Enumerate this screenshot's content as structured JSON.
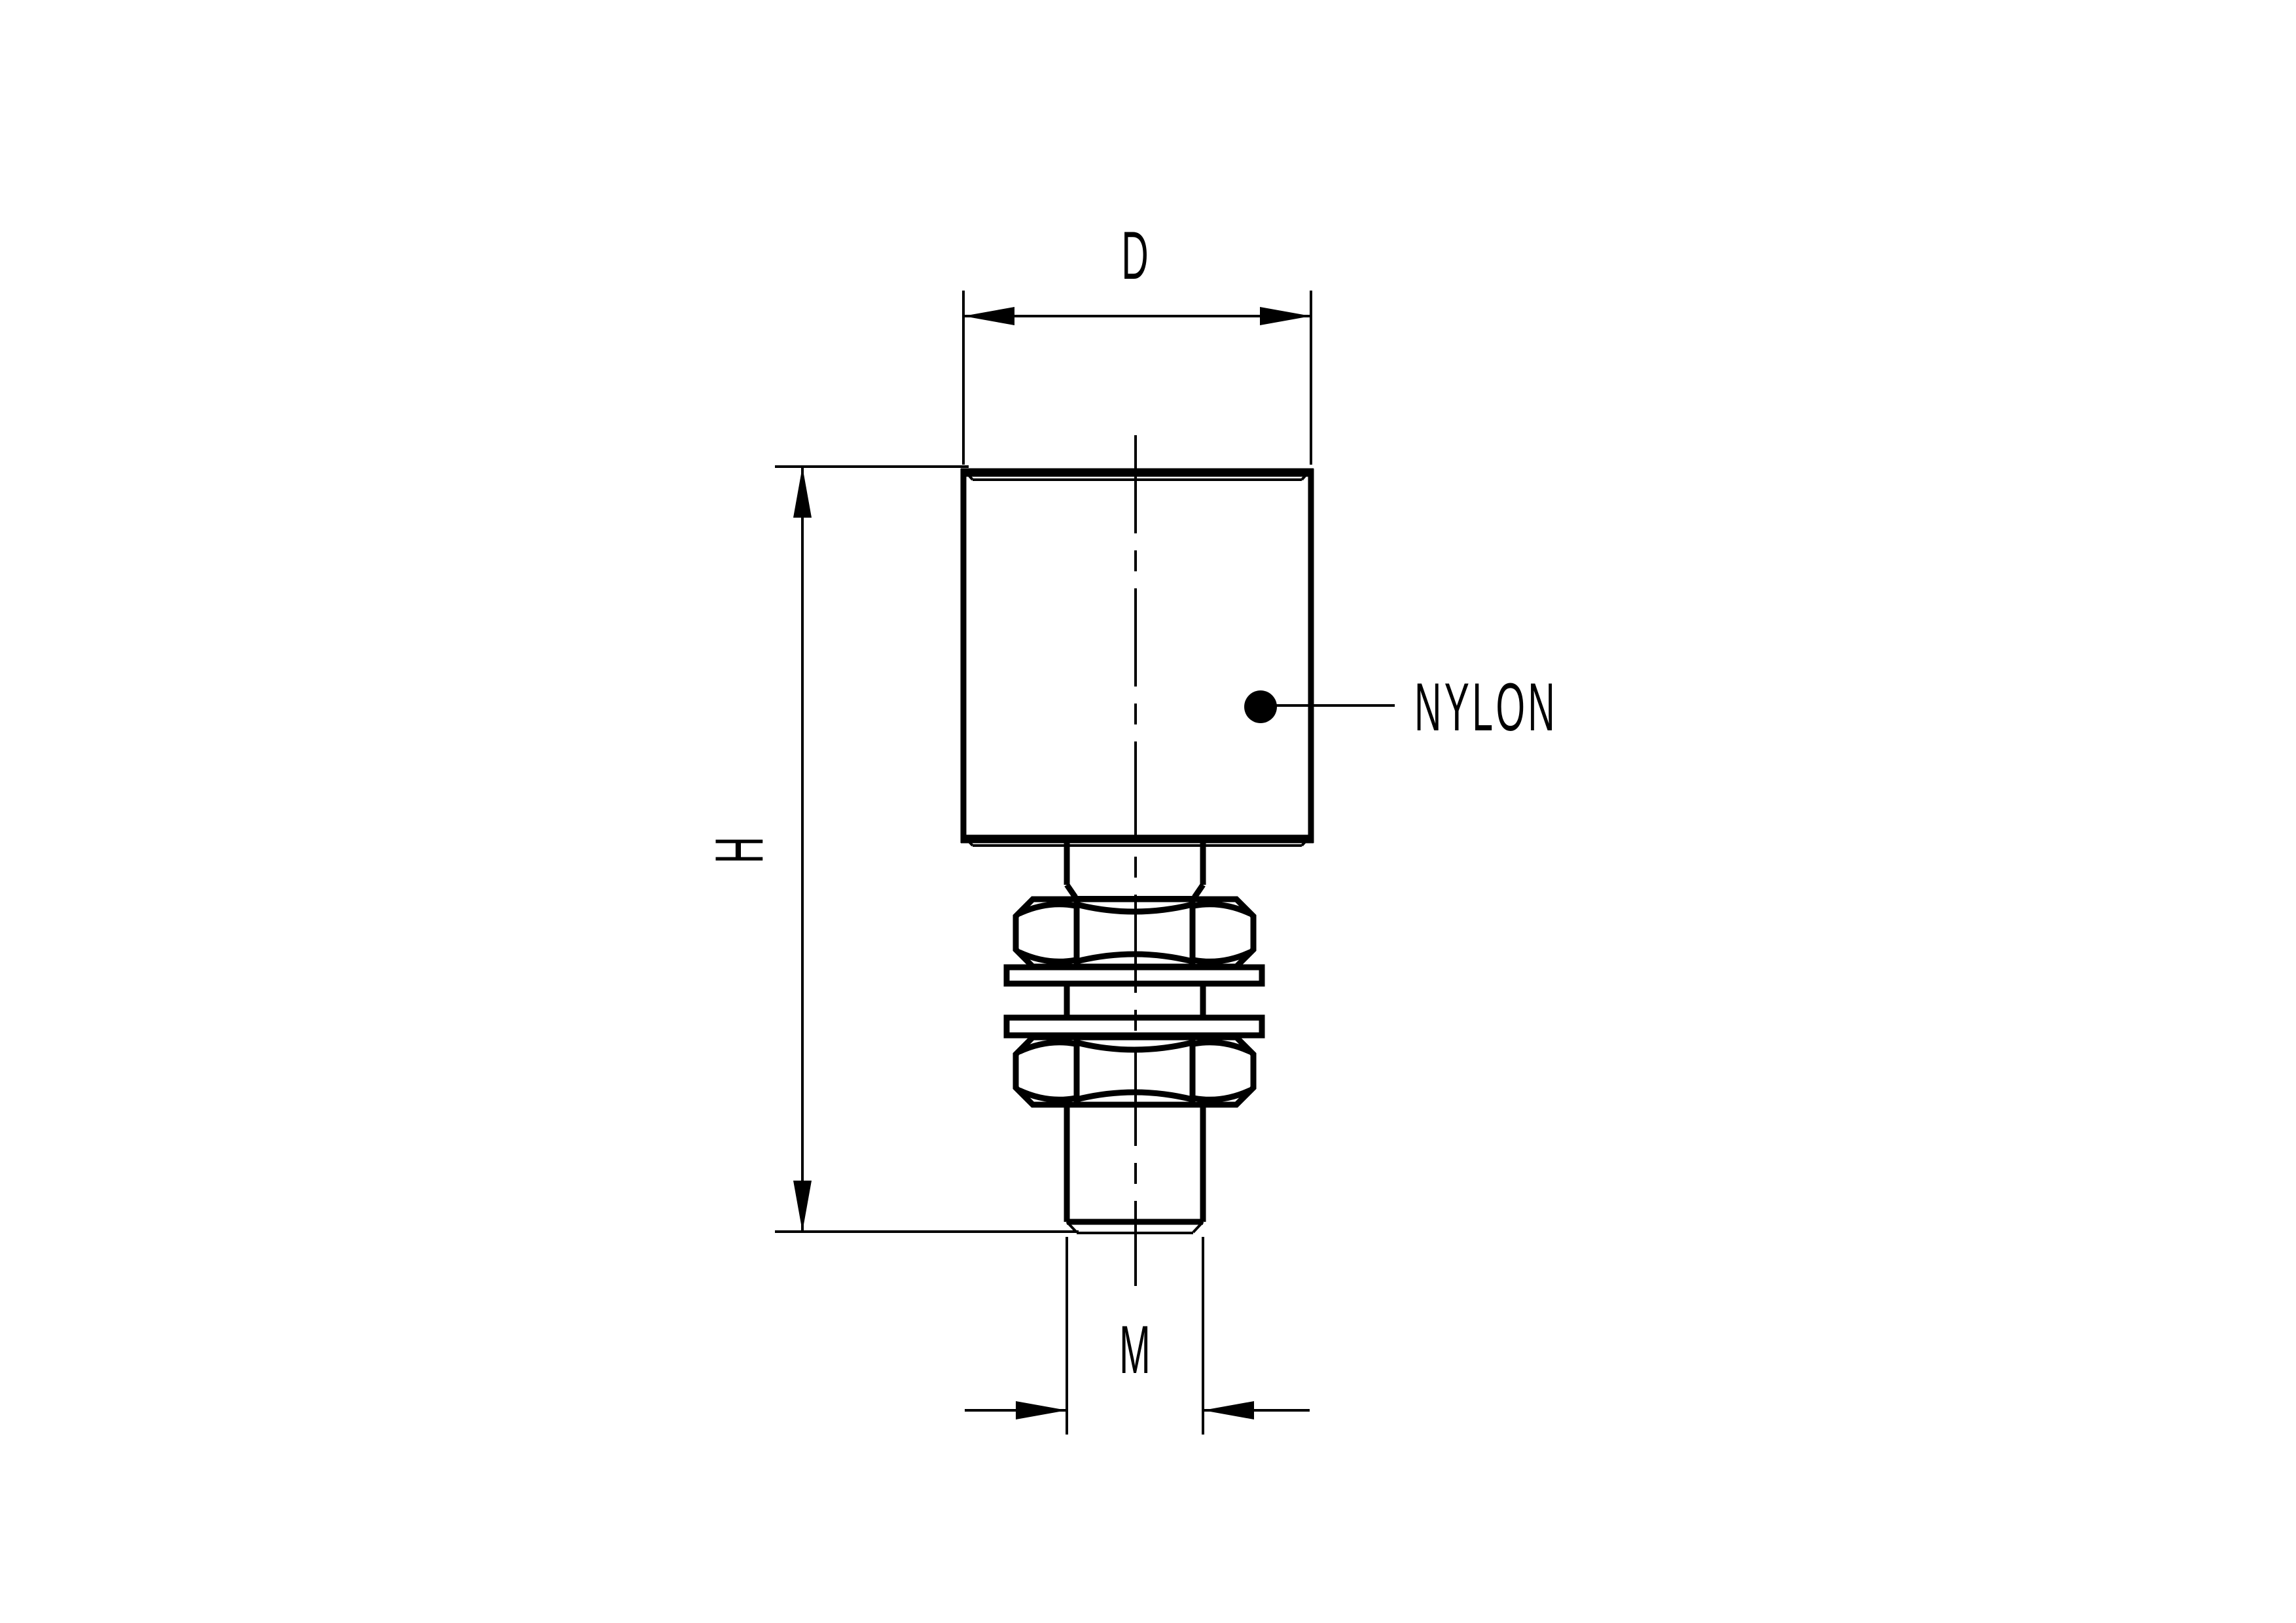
{
  "drawing": {
    "background_color": "#ffffff",
    "line_color": "#000000",
    "labels": {
      "diameter": "D",
      "height": "H",
      "thread": "M",
      "material": "NYLON"
    }
  }
}
